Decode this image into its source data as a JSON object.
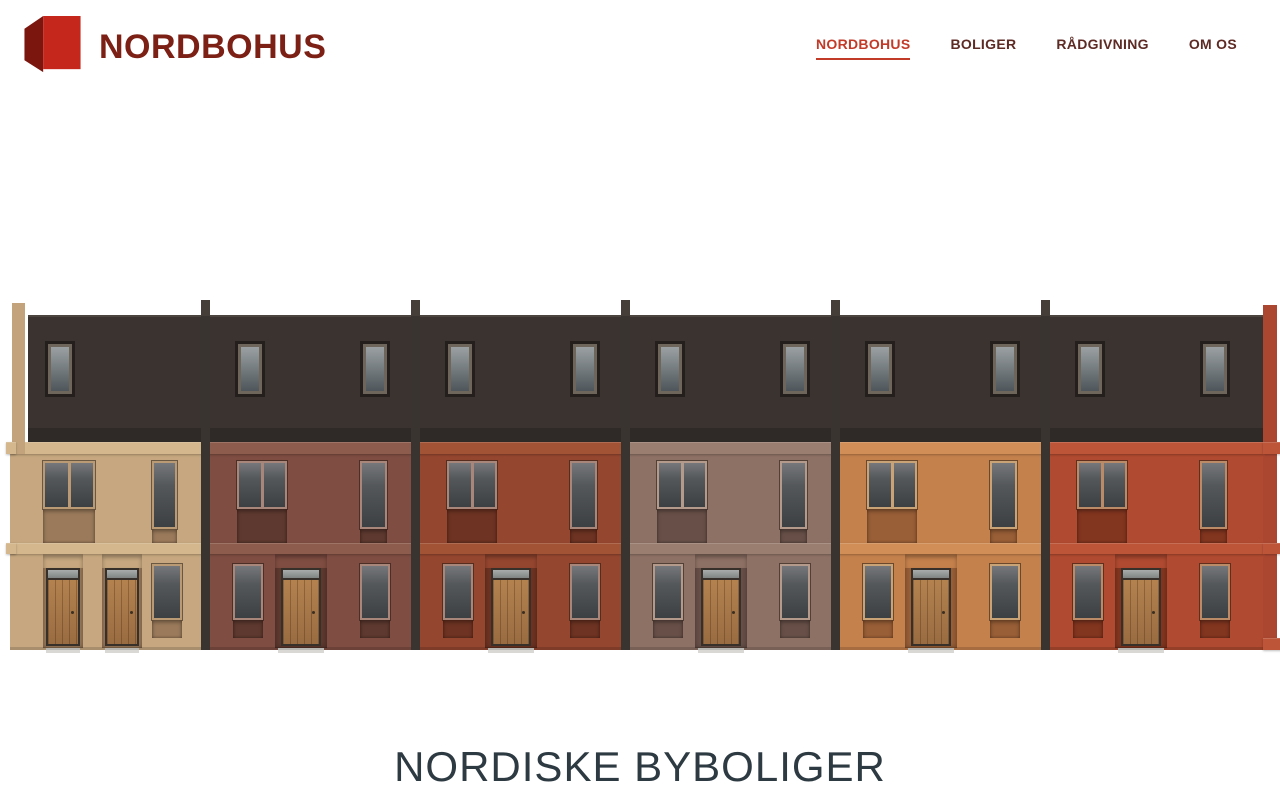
{
  "header": {
    "brand": "NORDBOHUS",
    "brand_color": "#7c2016",
    "logo": {
      "front_color": "#c5271c",
      "side_color": "#7b160f"
    },
    "nav_color": "#5d2a24",
    "nav_active_color": "#c23a28",
    "nav": [
      {
        "label": "NORDBOHUS",
        "active": true
      },
      {
        "label": "BOLIGER",
        "active": false
      },
      {
        "label": "RÅDGIVNING",
        "active": false
      },
      {
        "label": "OM OS",
        "active": false
      }
    ]
  },
  "hero": {
    "title": "NORDISKE BYBOLIGER",
    "title_color": "#2d3a42"
  },
  "illustration": {
    "description": "row of six nordic brick townhouses, elevation view",
    "roof_color": "#3a3330",
    "roof_edge_color": "#4c443f",
    "eave_color": "#2f2a27",
    "divider_color": "#3a3431",
    "post_color": "#453d38",
    "glass_top": "#75777a",
    "glass_bottom": "#3d4043",
    "dormer_frame_outer": "#241f1c",
    "dormer_frame_inner": "#6f665b",
    "dormer_glass_top": "#9ba1a3",
    "dormer_glass_bottom": "#4e565b",
    "door_frame_color": "#37302a",
    "transom_top": "#a9aeac",
    "transom_bottom": "#7f8583",
    "threshold_color": "#d9d8d4",
    "left_chimney_color": "#c2a37c",
    "right_column_color": "#ab4731",
    "houses": [
      {
        "name": "house-1-beige",
        "brick": "#c6a77f",
        "band": "#d4b78d",
        "panel": "#9b7a5b",
        "frame": "#b99a74",
        "doors": 2,
        "dormers": 1
      },
      {
        "name": "house-2-brown",
        "brick": "#7f4d42",
        "band": "#8d5c4c",
        "panel": "#5e392f",
        "frame": "#a8867a",
        "doors": 1,
        "dormers": 2
      },
      {
        "name": "house-3-red-brown",
        "brick": "#95462f",
        "band": "#a25336",
        "panel": "#6e3322",
        "frame": "#a8867a",
        "doors": 1,
        "dormers": 2
      },
      {
        "name": "house-4-mauve",
        "brick": "#8e7165",
        "band": "#9a7f70",
        "panel": "#685048",
        "frame": "#b49a8a",
        "doors": 1,
        "dormers": 2
      },
      {
        "name": "house-5-orange",
        "brick": "#c5814c",
        "band": "#d18e57",
        "panel": "#995f37",
        "frame": "#c9a276",
        "doors": 1,
        "dormers": 2
      },
      {
        "name": "house-6-red",
        "brick": "#b04a30",
        "band": "#bd5639",
        "panel": "#83361f",
        "frame": "#bb8a66",
        "doors": 1,
        "dormers": 2
      }
    ]
  }
}
